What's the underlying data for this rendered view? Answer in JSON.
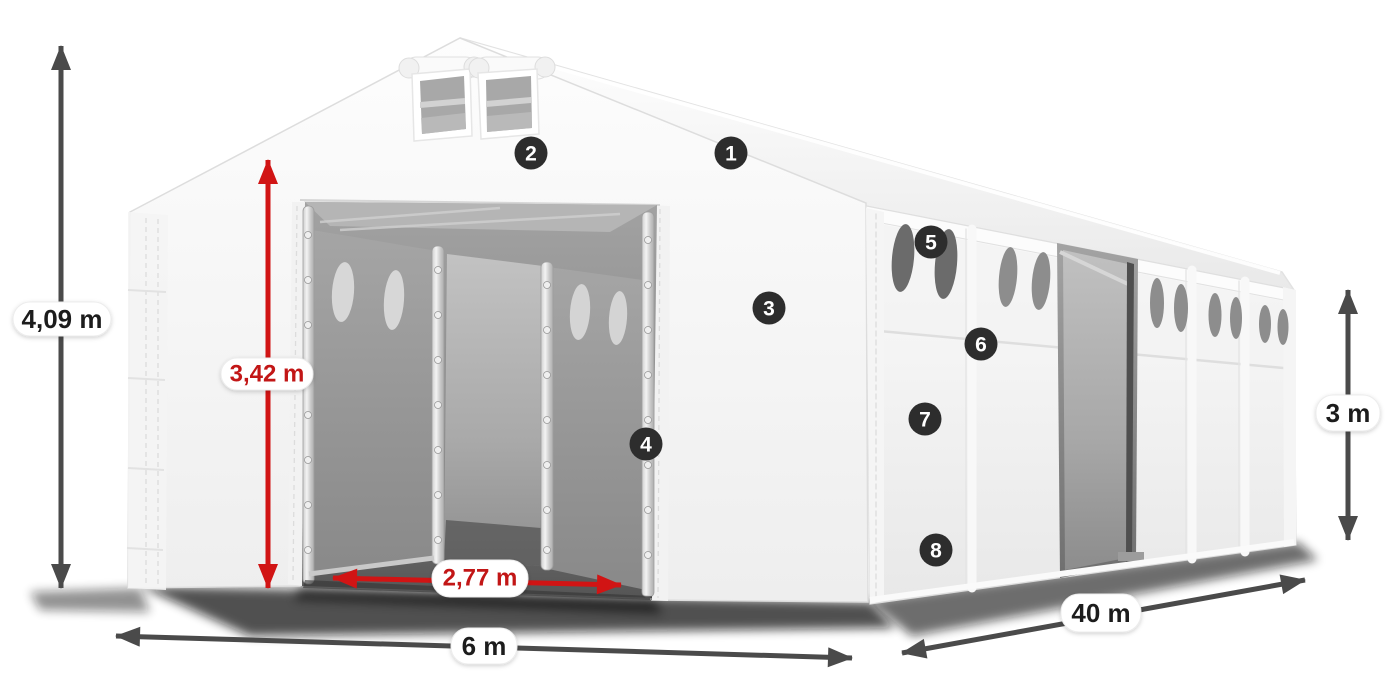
{
  "diagram": {
    "name": "storage-tent-dimensions-diagram",
    "background": "#ffffff"
  },
  "colors": {
    "dimension_dark": "#4a4a4a",
    "dimension_red": "#d11414",
    "label_text_dark": "#1f1f1f",
    "label_text_red": "#c21616",
    "label_background": "#ffffff",
    "badge_background": "#2d2d2d",
    "badge_text": "#ffffff"
  },
  "dimensions": {
    "total_height": {
      "label": "4,09 m"
    },
    "entrance_height": {
      "label": "3,42 m"
    },
    "entrance_width": {
      "label": "2,77 m"
    },
    "width": {
      "label": "6 m"
    },
    "length": {
      "label": "40 m"
    },
    "side_height": {
      "label": "3 m"
    }
  },
  "badges": [
    {
      "number": "1"
    },
    {
      "number": "2"
    },
    {
      "number": "3"
    },
    {
      "number": "4"
    },
    {
      "number": "5"
    },
    {
      "number": "6"
    },
    {
      "number": "7"
    },
    {
      "number": "8"
    }
  ]
}
